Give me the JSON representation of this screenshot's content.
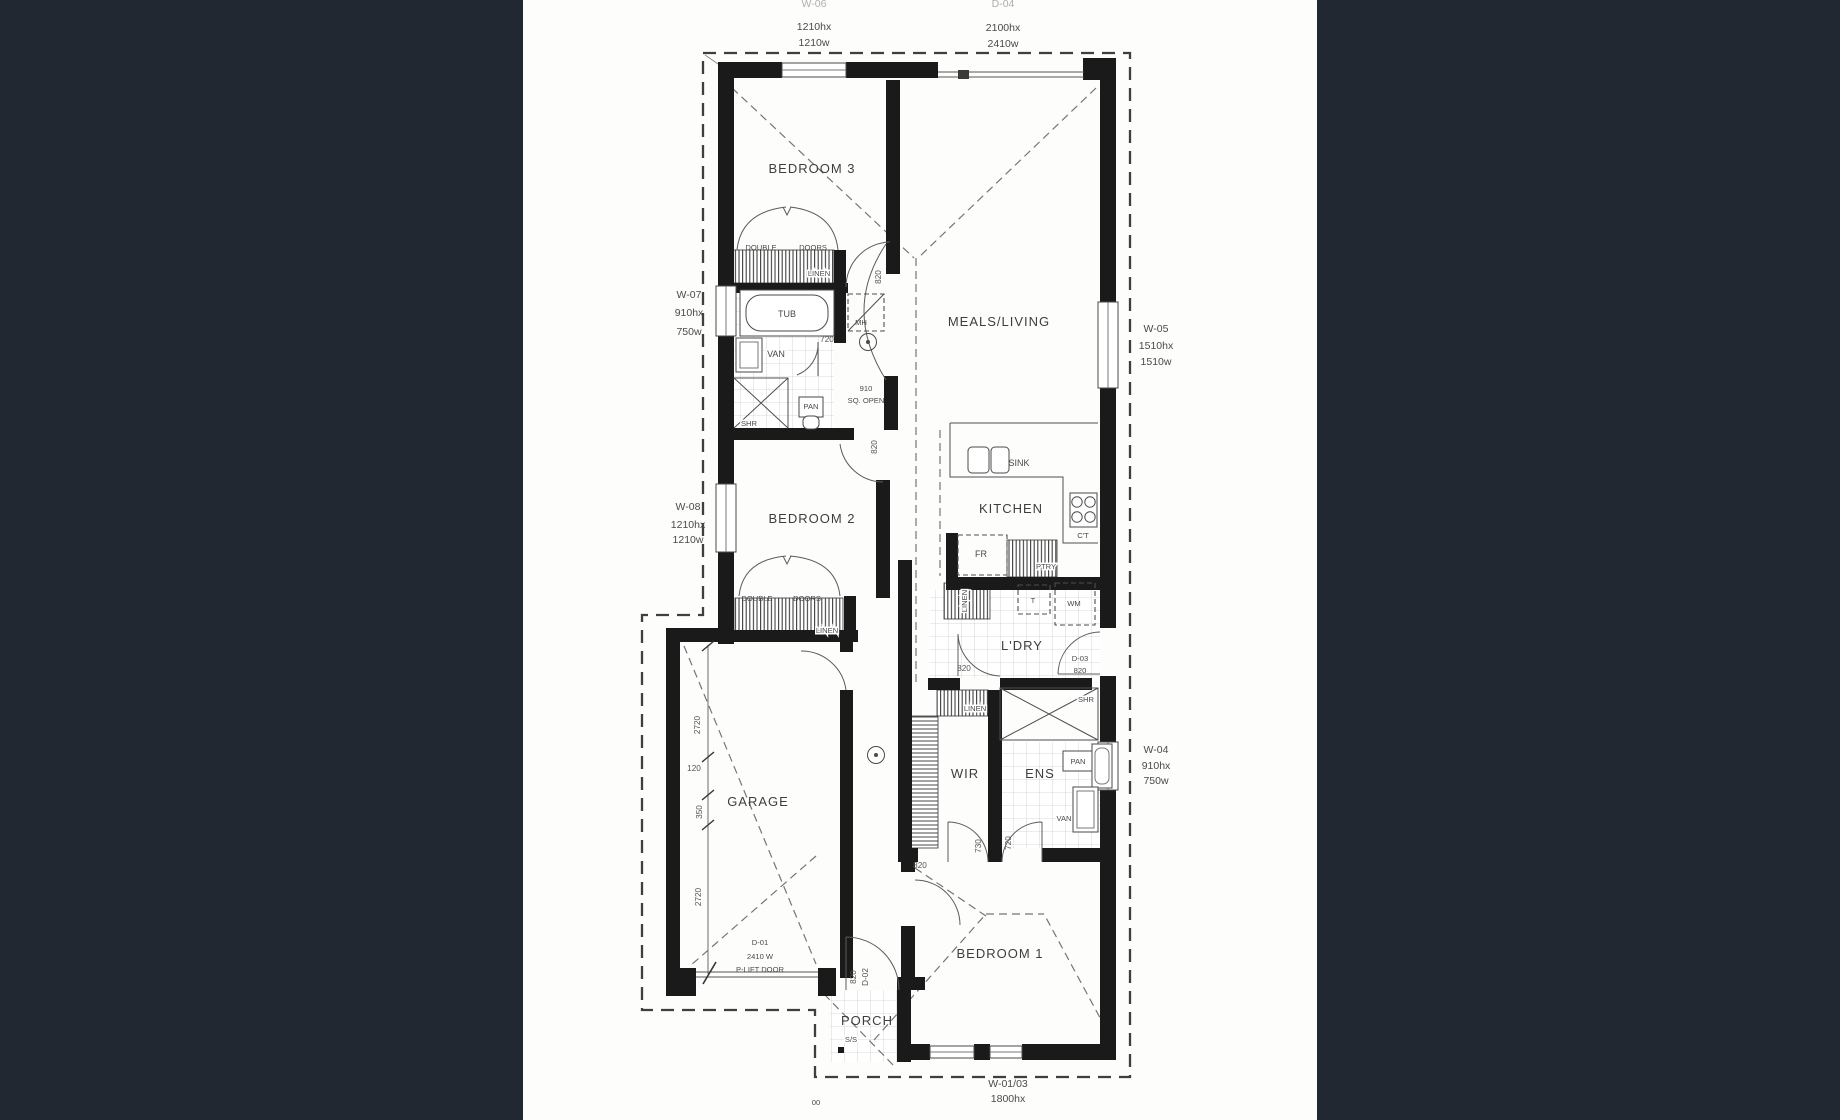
{
  "palette": {
    "band": "#212831",
    "sheet": "#fdfdfc",
    "wall": "#1a1a1a",
    "ink": "#424242"
  },
  "rooms": {
    "bedroom3": "BEDROOM 3",
    "meals_living": "MEALS/LIVING",
    "kitchen": "KITCHEN",
    "bedroom2": "BEDROOM 2",
    "laundry": "L'DRY",
    "wir": "WIR",
    "ens": "ENS",
    "garage": "GARAGE",
    "bedroom1": "BEDROOM 1",
    "porch": "PORCH"
  },
  "fixtures": {
    "tub": "TUB",
    "van": "VAN",
    "shr": "SHR",
    "pan": "PAN",
    "mh": "MH",
    "sink": "SINK",
    "cooktop": "C'T",
    "fridge": "FR",
    "pantry": "PTRY",
    "linen": "LINEN",
    "trough": "T",
    "wm": "WM",
    "ss": "S/S",
    "double": "DOUBLE",
    "doors": "DOORS",
    "sq_open_num": "910",
    "sq_open_text": "SQ. OPEN"
  },
  "labels": {
    "w06": {
      "id": "W-06",
      "hx": "1210hx",
      "w": "1210w"
    },
    "d04": {
      "id": "D-04",
      "hx": "2100hx",
      "w": "2410w"
    },
    "w07": {
      "id": "W-07",
      "hx": "910hx",
      "w": "750w"
    },
    "w08": {
      "id": "W-08",
      "hx": "1210hx",
      "w": "1210w"
    },
    "w05": {
      "id": "W-05",
      "hx": "1510hx",
      "w": "1510w"
    },
    "w04": {
      "id": "W-04",
      "hx": "910hx",
      "w": "750w"
    },
    "w0103": {
      "id": "W-01/03",
      "hx": "1800hx"
    },
    "d01": {
      "id": "D-01",
      "w": "2410 W",
      "type": "P-LIFT DOOR"
    },
    "d02": {
      "id": "D-02"
    },
    "d03": {
      "id": "D-03"
    }
  },
  "dims": {
    "d820": "820",
    "d720": "720",
    "d730": "730",
    "d2720": "2720",
    "d120": "120",
    "d350": "350",
    "mark": "00"
  }
}
